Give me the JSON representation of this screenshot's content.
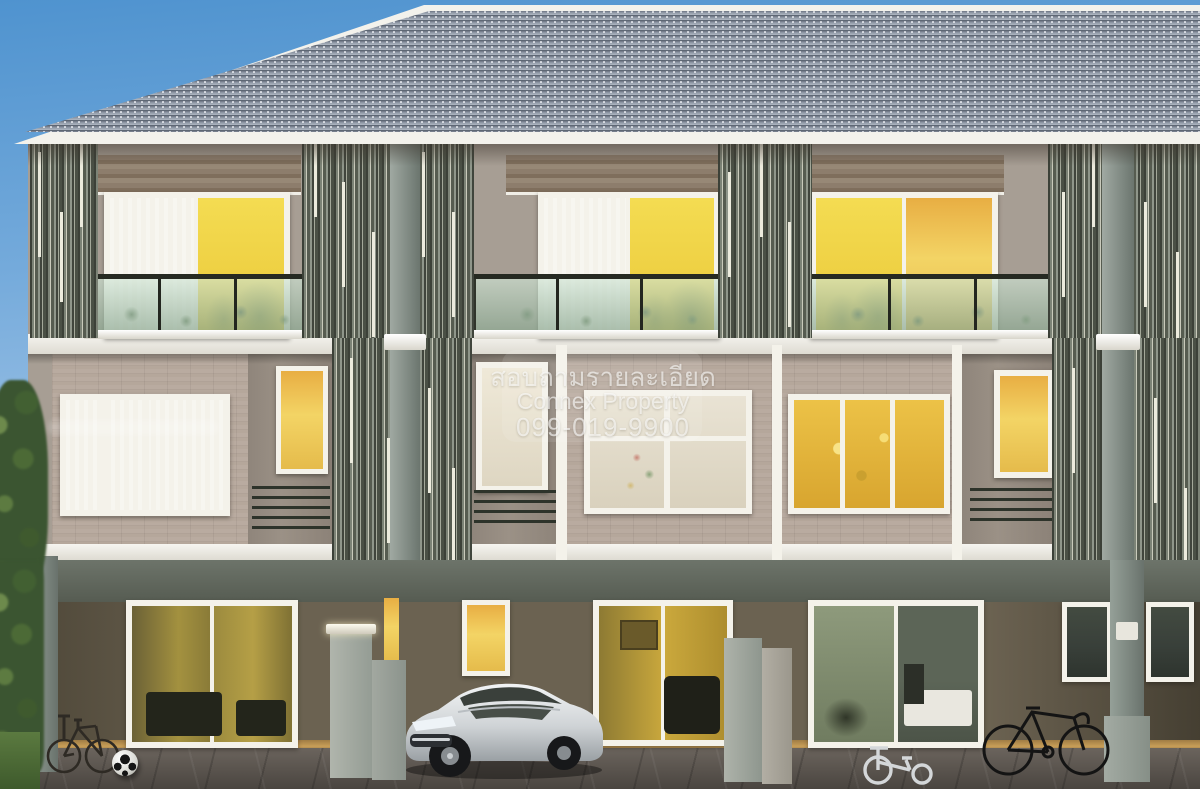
{
  "scene": {
    "description": "3D architectural rendering of a modern three-storey townhome row at dusk, warm lit interiors, vertical louver screens, carport with sedan, bicycles, tricycle and soccer ball",
    "objects": [
      "tiled-roof",
      "louver-screen",
      "balcony-glass-railing",
      "sliding-glass-door",
      "brick-wall",
      "fence-pillar",
      "sedan-car",
      "bicycle",
      "road-bike",
      "tricycle",
      "soccer-ball",
      "hedge",
      "tree",
      "driveway-pavers"
    ]
  },
  "watermark": {
    "line1": "สอบถามรายละเอียด",
    "line2": "Connex Property",
    "line3": "099-019-9900",
    "color": "#ffffff",
    "opacity": 0.6
  },
  "palette": {
    "sky_top": "#4f93cf",
    "sky_bottom": "#cfe2f2",
    "roof_tile": "#8b94a3",
    "fascia_white": "#f3f2ec",
    "upper_wall": "#a79e94",
    "brick_wall": "#b5a79b",
    "wood_panel": "#8a7a69",
    "louver_dark": "#3c4138",
    "louver_light": "#ccccbd",
    "window_glow": "#eec94d",
    "balcony_glass": "#a9c3b1",
    "ground_recess": "#5f584a",
    "column_gray": "#87918b",
    "pavement": "#57514b",
    "hedge_green": "#3b5531",
    "car_body": "#d9dbdd"
  }
}
